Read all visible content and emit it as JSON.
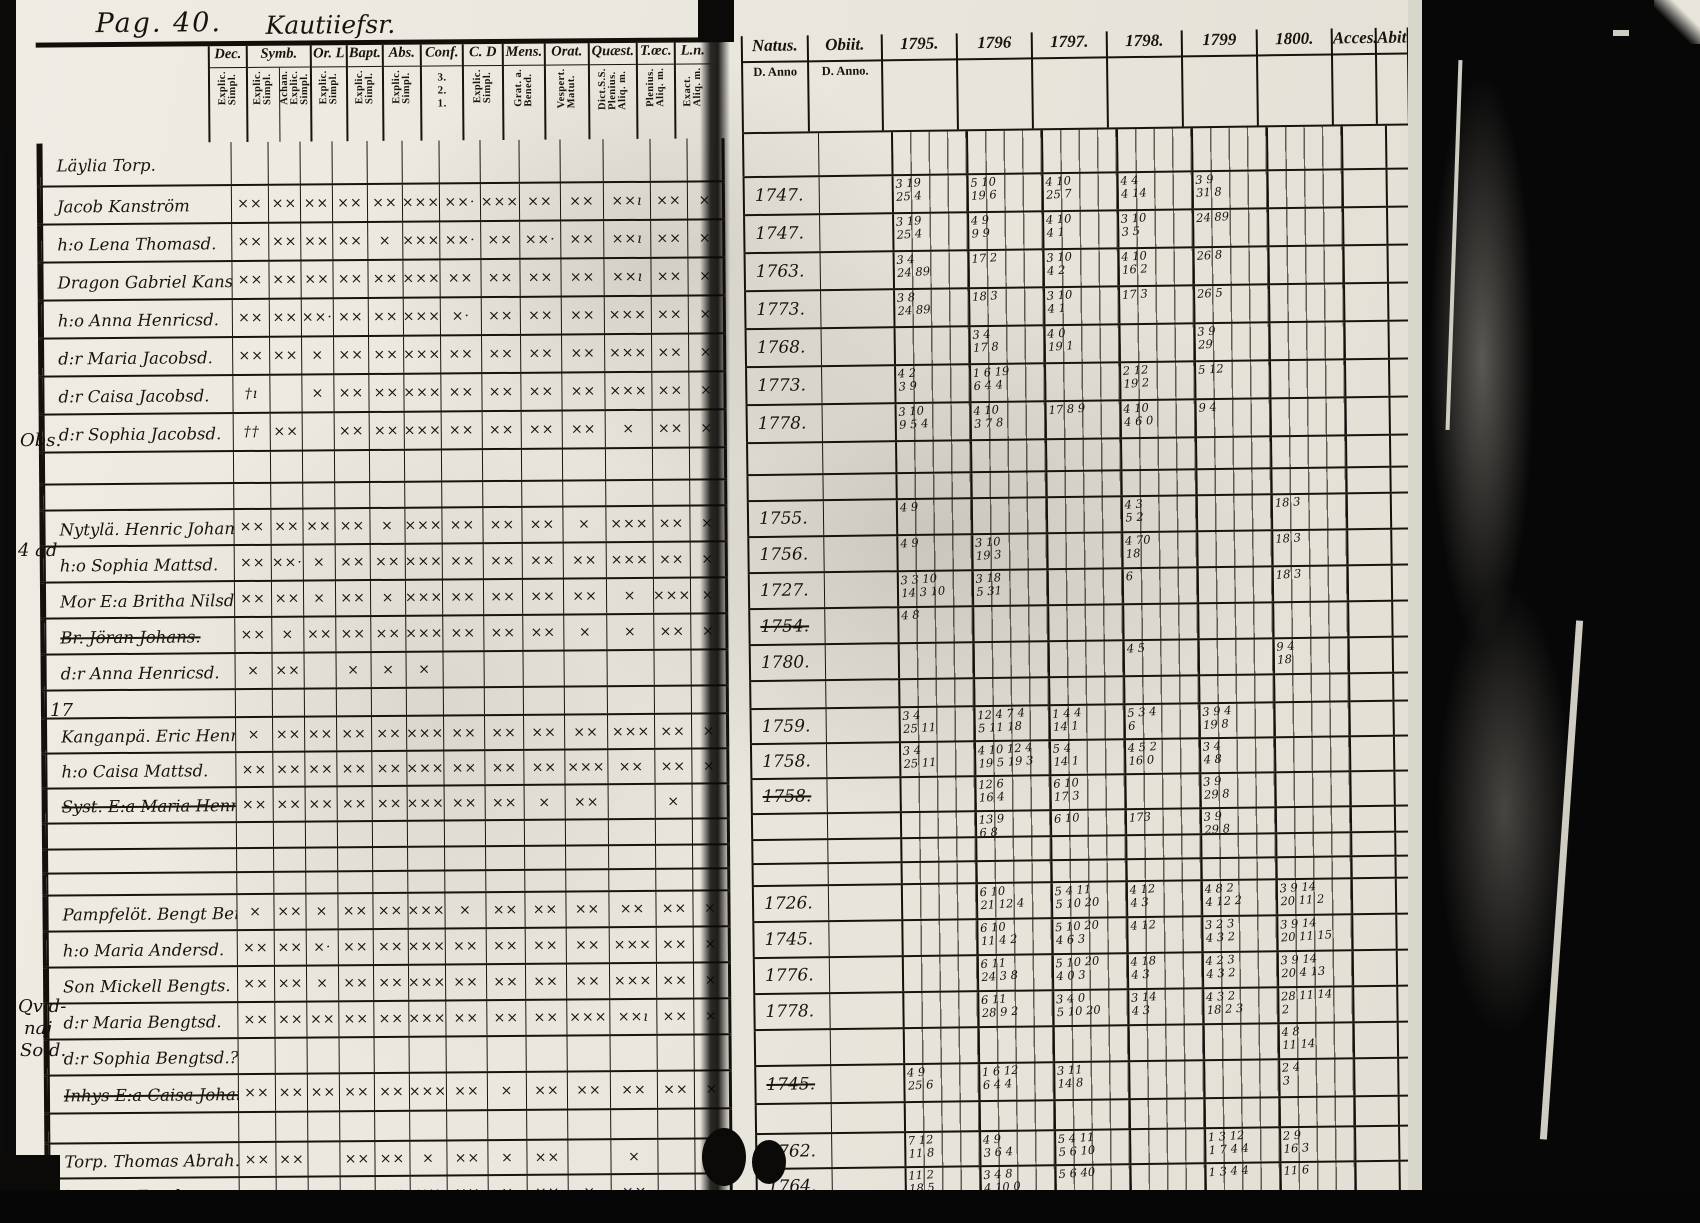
{
  "page": {
    "label": "Pag. 40.",
    "script_title": "Kautiiefsr.",
    "margin_notes": [
      {
        "text": "Obs.",
        "left": 4,
        "top": 430
      },
      {
        "text": "4 ad",
        "left": 2,
        "top": 540
      },
      {
        "text": "17",
        "left": 34,
        "top": 700
      },
      {
        "text": "Qvid-",
        "left": 2,
        "top": 996
      },
      {
        "text": "naj",
        "left": 8,
        "top": 1018
      },
      {
        "text": "Sold.",
        "left": 4,
        "top": 1040
      }
    ]
  },
  "left_table": {
    "heading_row": "Läylia Torp.",
    "columns": [
      {
        "label": "Dec.",
        "subs": [
          "Explic.\nSimpl."
        ]
      },
      {
        "label": "Symb.",
        "subs": [
          "Explic.\nSimpl.",
          "Achan.\nExplic.\nSimpl."
        ]
      },
      {
        "label": "Or. L",
        "subs": [
          "Explic.\nSimpl."
        ]
      },
      {
        "label": "Bapt.",
        "subs": [
          "Explic.\nSimpl."
        ]
      },
      {
        "label": "Abs.",
        "subs": [
          "Explic.\nSimpl."
        ]
      },
      {
        "label": "Conf.",
        "subs": [
          "3.\n2.\n1."
        ]
      },
      {
        "label": "C. D",
        "subs": [
          "Explic.\nSimpl."
        ]
      },
      {
        "label": "Mens.",
        "subs": [
          "Grat. a.\nBened."
        ]
      },
      {
        "label": "Orat.",
        "subs": [
          "Vespert.\nMatut."
        ]
      },
      {
        "label": "Quæst.",
        "subs": [
          "Dict.S.S.\nPlenius.\nAliq. m."
        ]
      },
      {
        "label": "T.œc.",
        "subs": [
          "Plenius.\nAliq. m."
        ]
      },
      {
        "label": "L.n.",
        "subs": [
          "Exact.\nAliq. m."
        ]
      }
    ]
  },
  "right_table": {
    "natus_label": "Natus.",
    "natus_sub": "D. Anno",
    "obiit_label": "Obiit.",
    "obiit_sub": "D. Anno.",
    "years": [
      "1795.",
      "1796",
      "1797.",
      "1798.",
      "1799",
      "1800."
    ],
    "acces_label": "Acces.",
    "abit_label": "Abit"
  },
  "rows": [
    {
      "t": "heading",
      "h": 42,
      "name": "Läylia Torp."
    },
    {
      "t": "p",
      "h": 36,
      "name": "Jacob Kanström",
      "natus": "1747.",
      "marks": "××,××,××,××,××,×××,××·,×××,××,××,××ı,××,×",
      "years": {
        "1795.": "3 19/25 4",
        "1796": "5 10/19 6",
        "1797.": "4 10/25 7",
        "1798.": "4 4/4 14",
        "1799": "3 9/31 8"
      }
    },
    {
      "t": "p",
      "h": 36,
      "name": "h:o Lena Thomasd.",
      "natus": "1747.",
      "marks": "××,××,××,××,×,×××,××·,××,××·,××,××ı,××,×",
      "years": {
        "1795.": "3 19/25 4",
        "1796": "4 9/9 9",
        "1797.": "4 10/4 1",
        "1798.": "3 10/3 5",
        "1799": "24 89"
      }
    },
    {
      "t": "p",
      "h": 36,
      "name": "Dragon Gabriel Kanst.",
      "natus": "1763.",
      "marks": "××,××,××,××,××,×××,××,××,××,××,××ı,××,×",
      "years": {
        "1795.": "3 4/24 89",
        "1796": "17 2",
        "1797.": "3 10/4 2",
        "1798.": "4 10/16 2",
        "1799": "26 8"
      }
    },
    {
      "t": "p",
      "h": 36,
      "name": "h:o Anna Henricsd.",
      "natus": "1773.",
      "marks": "××,××,××·,××,××,×××,×·,××,××,××,×××,××,×",
      "years": {
        "1795.": "3 8/24 89",
        "1796": "18 3",
        "1797.": "3 10/4 1",
        "1798.": "17 3",
        "1799": "26 5"
      }
    },
    {
      "t": "p",
      "h": 36,
      "name": "d:r Maria Jacobsd.",
      "natus": "1768.",
      "marks": "××,××,×,××,××,×××,××,××,××,××,×××,××,×",
      "years": {
        "1796": "3 4/17 8",
        "1797.": "4 0/19 1",
        "1799": "3 9/29"
      }
    },
    {
      "t": "p",
      "h": 36,
      "name": "d:r Caisa Jacobsd.",
      "natus": "1773.",
      "marks": "†ı,,×,××,××,×××,××,××,××,××,×××,××,×",
      "years": {
        "1795.": "4 2/3 9",
        "1796": "1 6 19/6 4 4",
        "1798.": "2 12/19 2",
        "1799": "5 12"
      }
    },
    {
      "t": "p",
      "h": 36,
      "name": "d:r Sophia Jacobsd.",
      "natus": "1778.",
      "marks": "††,××,,××,××,×××,××,××,××,××,×,××,×",
      "years": {
        "1795.": "3 10/9 5 4",
        "1796": "4 10/3 7 8",
        "1797.": "17 8 9",
        "1798.": "4 10/4 6 0",
        "1799": "9 4"
      }
    },
    {
      "t": "blank",
      "h": 30
    },
    {
      "t": "blank",
      "h": 24
    },
    {
      "t": "p",
      "h": 34,
      "name": "Nytylä. Henric Johans.",
      "natus": "1755.",
      "marks": "××,××,××,××,×,×××,××,××,××,×,×××,××,×",
      "years": {
        "1795.": "4 9",
        "1798.": "4 3/5 2",
        "1800.": "18 3"
      }
    },
    {
      "t": "p",
      "h": 34,
      "name": "h:o Sophia Mattsd.",
      "natus": "1756.",
      "marks": "××,××·,×,××,××,×××,××,××,××,××,×××,××,×",
      "years": {
        "1795.": "4 9",
        "1796": "3 10/19 3",
        "1798.": "4 70/18",
        "1800.": "18 3"
      }
    },
    {
      "t": "p",
      "h": 34,
      "name": "Mor E:a Britha Nilsd.",
      "natus": "1727.",
      "marks": "××,××,×,××,×,×××,××,××,××,××,×,×××,×",
      "years": {
        "1795.": "3 3 10/14 3 10",
        "1796": "3 18/5 31",
        "1798.": "6",
        "1800.": "18 3"
      }
    },
    {
      "t": "p",
      "h": 34,
      "name": "Br. Jöran Johans.",
      "natus": "1754.",
      "struck": true,
      "marks": "××,×,××,××,××,×××,××,××,××,×,×,××,×",
      "years": {
        "1795.": "4 8"
      }
    },
    {
      "t": "p",
      "h": 34,
      "name": "d:r Anna Henricsd.",
      "natus": "1780.",
      "marks": "×,××,,×,×,×,,,,,,,",
      "years": {
        "1798.": "4 5",
        "1800.": "9 4/18"
      }
    },
    {
      "t": "blank",
      "h": 26
    },
    {
      "t": "p",
      "h": 33,
      "name": "Kanganpä. Eric Henrics.",
      "natus": "1759.",
      "marks": "×,××,××,××,××,×××,××,××,××,××,×××,××,×",
      "years": {
        "1795.": "3 4/25 11",
        "1796": "12 4 7 4/5 11 18",
        "1797.": "1 4 4/14 1",
        "1798.": "5 3 4/6",
        "1799": "3 9 4/19 8"
      }
    },
    {
      "t": "p",
      "h": 33,
      "name": "h:o Caisa Mattsd.",
      "natus": "1758.",
      "marks": "××,××,××,××,××,×××,××,××,××,×××,××,××,×",
      "years": {
        "1795.": "3 4/25 11",
        "1796": "4 10 12 4/19 5 19 3",
        "1797.": "5 4/14 1",
        "1798.": "4 5 2/16 0",
        "1799": "3 4/4 8"
      }
    },
    {
      "t": "p",
      "h": 33,
      "name": "Syst. E:a Maria Henricsd.",
      "natus": "1758.",
      "struck": true,
      "marks": "××,××,××,××,××,×××,××,××,×,××,,×,",
      "years": {
        "1796": "12 6/16 4",
        "1797.": "6 10/17 3",
        "1799": "3 9/29 8"
      }
    },
    {
      "t": "blank",
      "h": 24,
      "years": {
        "1796": "13 9/6 8",
        "1797.": "6 10",
        "1798.": "173",
        "1799": "3 9/29 8"
      }
    },
    {
      "t": "blank",
      "h": 22
    },
    {
      "t": "blank",
      "h": 20
    },
    {
      "t": "p",
      "h": 34,
      "name": "Pampfelöt. Bengt Bengts.",
      "natus": "1726.",
      "marks": "×,××,×,××,××,×××,×,××,××,××,××,××,×",
      "years": {
        "1796": "6 10/21 12 4",
        "1797.": "5 4 11/5 10 20",
        "1798.": "4 12/4 3",
        "1799": "4 8 2/4 12 2",
        "1800.": "3 9 14/20 11 2"
      }
    },
    {
      "t": "p",
      "h": 34,
      "name": "h:o Maria Andersd.",
      "natus": "1745.",
      "marks": "××,××,×·,××,××,×××,××,××,××,××,×××,××,×",
      "years": {
        "1796": "6 10/11 4 2",
        "1797.": "5 10 20/4 6 3",
        "1798.": "4 12",
        "1799": "3 2 3/4 3 2",
        "1800.": "3 9 14/20 11 15"
      }
    },
    {
      "t": "p",
      "h": 34,
      "name": "Son Mickell Bengts.",
      "natus": "1776.",
      "marks": "××,××,×,××,××,×××,××,××,××,××,×××,××,×",
      "years": {
        "1796": "6 11/24 3 8",
        "1797.": "5 10 20/4 0 3",
        "1798.": "4 18/4 3",
        "1799": "4 2 3/4 3 2",
        "1800.": "3 9 14/20 4 13"
      }
    },
    {
      "t": "p",
      "h": 34,
      "name": "d:r Maria Bengtsd.",
      "natus": "1778.",
      "marks": "××,××,××,××,××,×××,××,××,××,×××,××ı,××,×",
      "years": {
        "1796": "6 11/28 9 2",
        "1797.": "3 4 0/5 10 20",
        "1798.": "3 14/4 3",
        "1799": "4 3 2/18 2 3",
        "1800.": "28 11 14/2"
      }
    },
    {
      "t": "p",
      "h": 34,
      "name": "d:r Sophia Bengtsd.?",
      "natus": "",
      "marks": ",,,,,,,,,,,,",
      "years": {
        "1800.": "4 8/11 14"
      }
    },
    {
      "t": "p",
      "h": 36,
      "name": "Inhys E:a Caisa Johansdinne",
      "natus": "1745.",
      "struck": true,
      "marks": "××,××,××,××,××,×××,××,×,××,××,××,××,×",
      "years": {
        "1795.": "4 9/25 6",
        "1796": "1 6 12/6 4 4",
        "1797.": "3 11/14 8",
        "1800.": "2 4/3"
      }
    },
    {
      "t": "blank",
      "h": 28
    },
    {
      "t": "p",
      "h": 33,
      "name": "Torp. Thomas Abrah.",
      "natus": "1762.",
      "marks": "××,××,,××,××,×,××,×,××,,×,,",
      "years": {
        "1795.": "7 12/11 8",
        "1796": "4 9/3 6 4",
        "1797.": "5 4 11/5 6 10",
        "1799": "1 3 12/1 7 4 4",
        "1800.": "2 9/16 3"
      }
    },
    {
      "t": "p",
      "h": 33,
      "name": "h:o Lisa Ers d:r",
      "natus": "1764.",
      "marks": "××,××,×,××,××,××,××,×,××,×,××,,",
      "years": {
        "1795.": "11 2/18 5",
        "1796": "3 4 8/4 10 0",
        "1797.": "5 6 40",
        "1799": "1 3 4 4",
        "1800.": "11 6"
      }
    },
    {
      "t": "p",
      "h": 33,
      "name": "Dr. Pehr Petters.",
      "natus": "1775.",
      "struck": true,
      "marks": "×,×,,×,××,×,×,××,××ı,,,,",
      "years": {
        "1796": "44",
        "1797.": "3 10 32"
      }
    }
  ]
}
